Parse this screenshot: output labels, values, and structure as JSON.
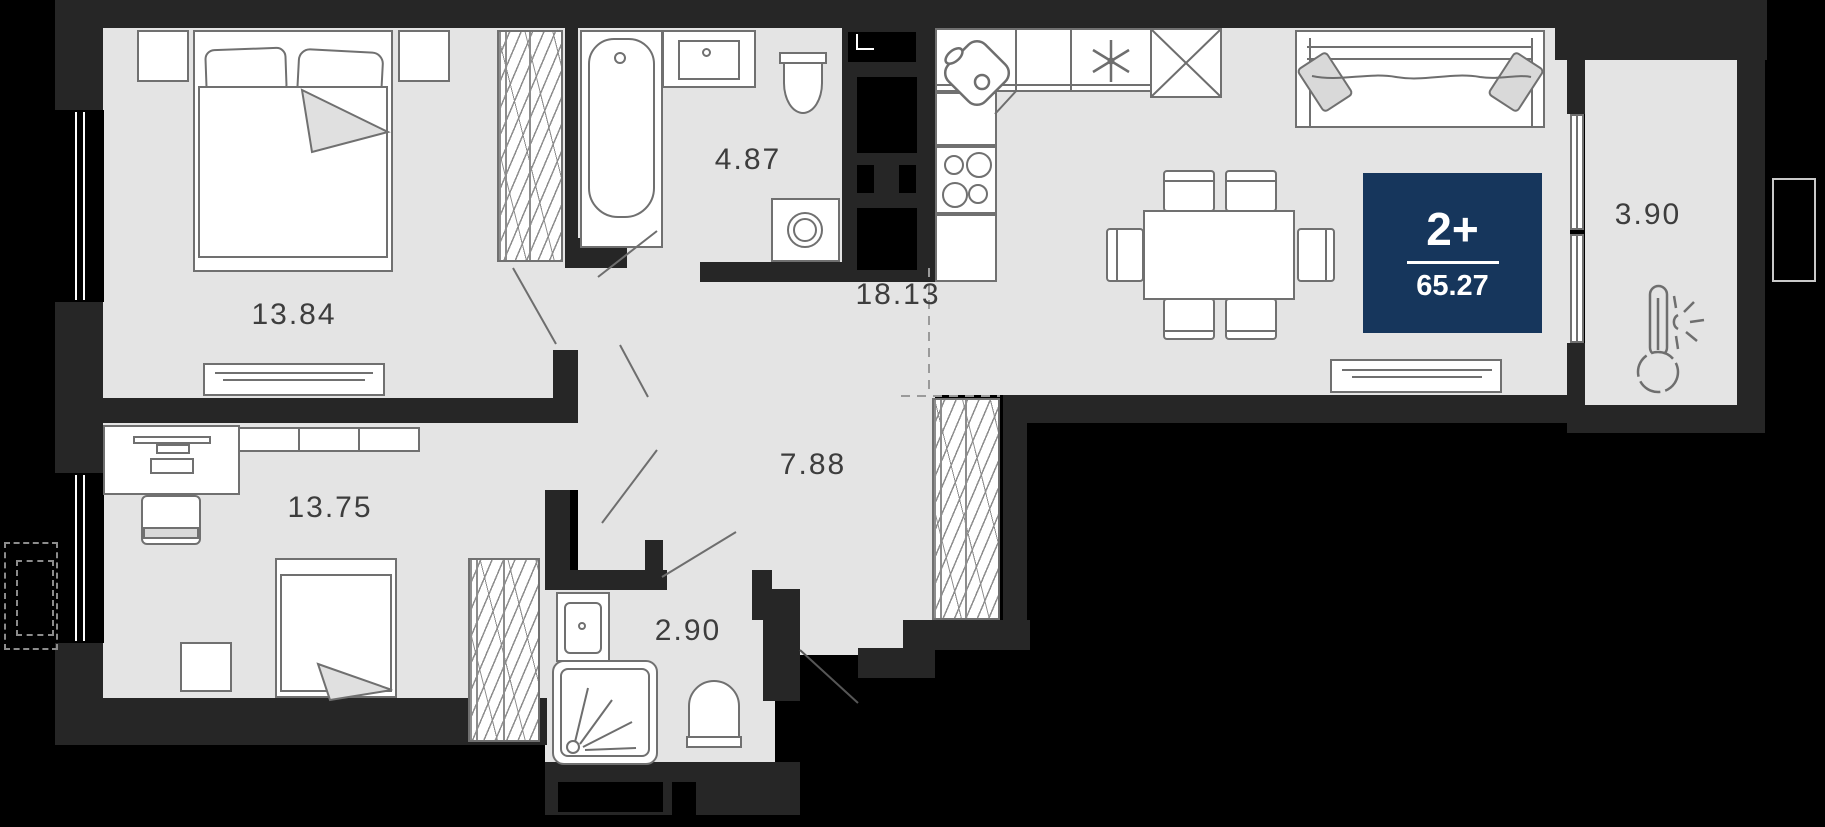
{
  "plan": {
    "badge": {
      "rooms": "2+",
      "area": "65.27"
    },
    "labels": {
      "bedroom1": "13.84",
      "bathroom1": "4.87",
      "living_kitchen": "18.13",
      "hall": "7.88",
      "bedroom2": "13.75",
      "bathroom2": "2.90",
      "balcony": "3.90"
    },
    "colors": {
      "wall": "#262626",
      "floor": "#e4e4e4",
      "badge_bg": "#16365c",
      "furniture_stroke": "#707070",
      "label_text": "#3d3d3d"
    },
    "icons": [
      "fridge-snowflake-icon",
      "thermometer-sun-icon"
    ]
  }
}
